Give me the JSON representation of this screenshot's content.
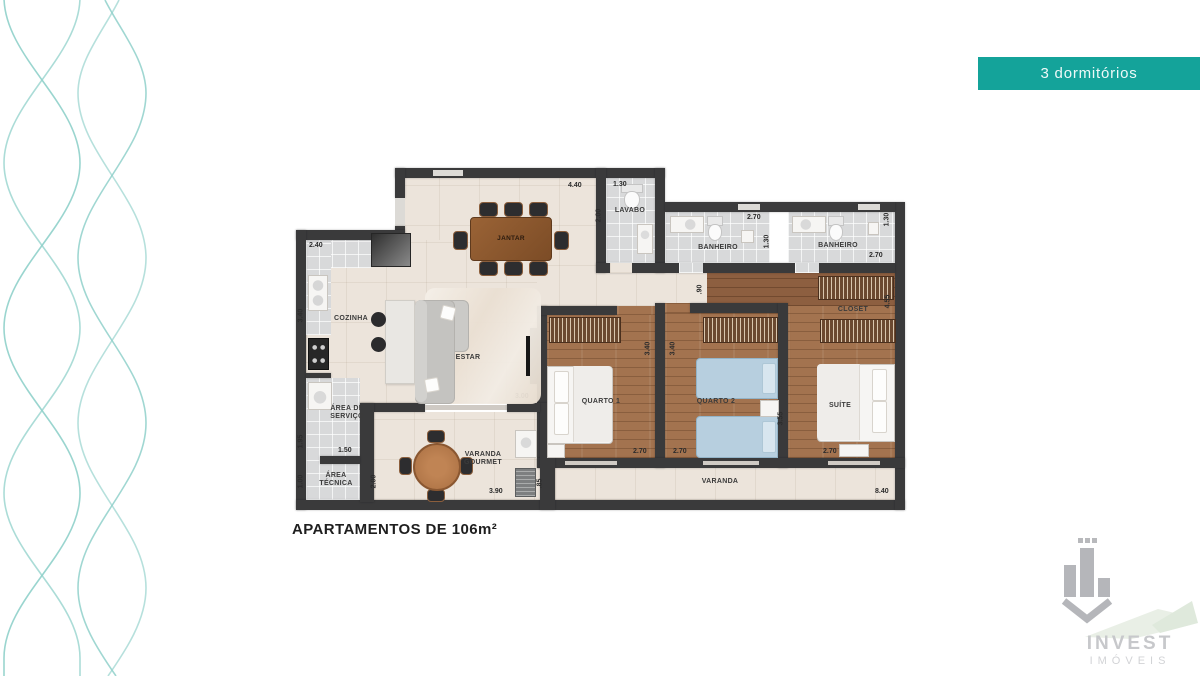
{
  "banner": {
    "label": "3 dormitórios",
    "bg": "#14a39a"
  },
  "title": {
    "text": "APARTAMENTOS DE 106m²"
  },
  "logo": {
    "name": "INVEST",
    "subtitle": "IMÓVEIS"
  },
  "rooms": {
    "jantar": "JANTAR",
    "lavabo": "LAVABO",
    "banheiro_social": "BANHEIRO",
    "banheiro_suite": "BANHEIRO",
    "cozinha": "COZINHA",
    "estar": "ESTAR",
    "area_servico": "ÁREA DE SERVIÇO",
    "area_tecnica": "ÁREA TÉCNICA",
    "varanda_gourmet": "VARANDA GOURMET",
    "quarto1": "QUARTO 1",
    "quarto2": "QUARTO 2",
    "suite": "SUÍTE",
    "closet": "CLOSET",
    "varanda": "VARANDA"
  },
  "dims": {
    "jantar_w": "4.40",
    "lavabo_w": "1.30",
    "lavabo_h": "2.00",
    "banheiro_social_w": "2.70",
    "banheiro_social_h": "1.30",
    "banheiro_suite_h": "1.30",
    "banheiro_suite_w": "2.70",
    "cozinha_w": "2.40",
    "cozinha_h": "3.40",
    "hall": ".90",
    "closet_h": "4.55",
    "quarto1_h": "3.40",
    "quarto2_h": "3.40",
    "quarto1_w": "2.70",
    "quarto2_w": "2.70",
    "suite_w": "2.70",
    "suite_h": "3.55",
    "estar_door": "3.00",
    "servico_h": "1.95",
    "servico_w": "1.50",
    "tecnica_h": "1.00",
    "gourmet_h": "2.00",
    "gourmet_w": "3.90",
    "varanda_h": ".85",
    "varanda_w": "8.40"
  },
  "colors": {
    "accent": "#14a39a",
    "wall": "#3a3a3b",
    "wave": "#8fd0ca"
  }
}
